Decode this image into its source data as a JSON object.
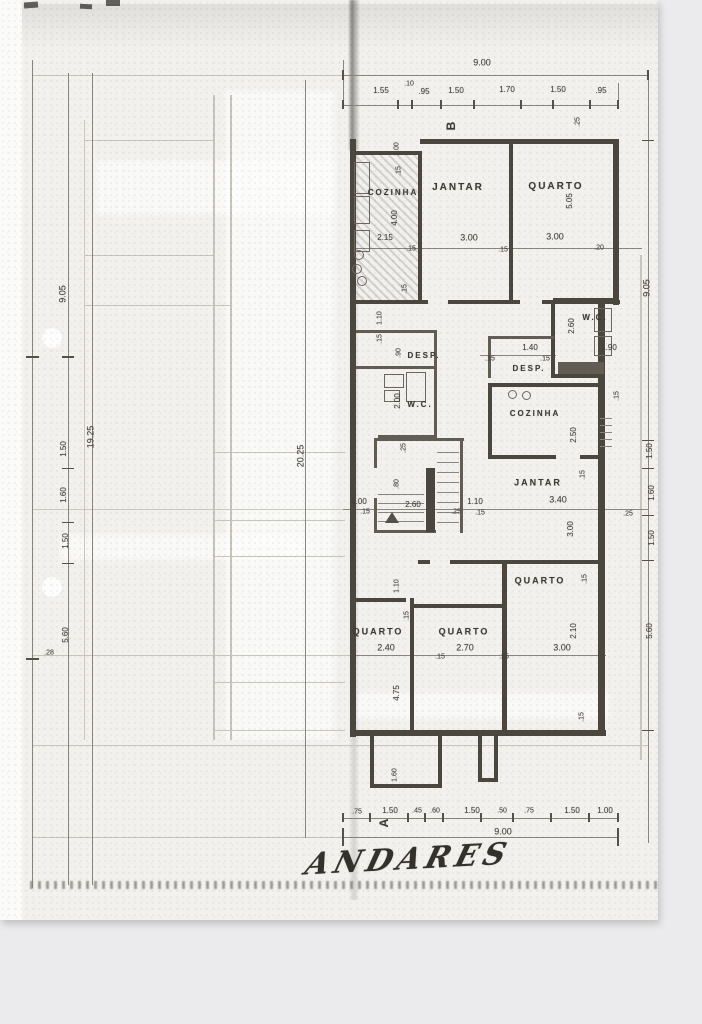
{
  "colors": {
    "ink": "#474339",
    "page": "#f2f1ee",
    "background": "#ebebed"
  },
  "plan": {
    "title": "ANDARES",
    "section_markers": {
      "top": "B",
      "bottom": "A"
    },
    "annotations": [
      {
        "n": "dim-label",
        "t": "9.00",
        "x": 482,
        "y": 63,
        "s": 9
      },
      {
        "n": "dim-label",
        "t": "1.55",
        "x": 381,
        "y": 91,
        "s": 8
      },
      {
        "n": "dim-label",
        "t": ".10",
        "x": 409,
        "y": 84,
        "s": 7
      },
      {
        "n": "dim-label",
        "t": ".95",
        "x": 424,
        "y": 92,
        "s": 8
      },
      {
        "n": "dim-label",
        "t": "1.50",
        "x": 456,
        "y": 91,
        "s": 8
      },
      {
        "n": "dim-label",
        "t": "1.70",
        "x": 507,
        "y": 90,
        "s": 8
      },
      {
        "n": "dim-label",
        "t": "1.50",
        "x": 558,
        "y": 90,
        "s": 8
      },
      {
        "n": "dim-label",
        "t": ".95",
        "x": 601,
        "y": 91,
        "s": 8
      },
      {
        "n": "section-marker-b",
        "t": "B",
        "x": 451,
        "y": 126,
        "r": -90,
        "s": 12,
        "c": "marker"
      },
      {
        "n": "dim-label",
        "t": ".25",
        "x": 578,
        "y": 122,
        "r": -90,
        "s": 7
      },
      {
        "n": "room-label-cozinha-top",
        "t": "COZINHA",
        "x": 393,
        "y": 193,
        "s": 8,
        "c": "room"
      },
      {
        "n": "room-label-jantar-top",
        "t": "JANTAR",
        "x": 458,
        "y": 188,
        "s": 10,
        "c": "room"
      },
      {
        "n": "room-label-quarto-top",
        "t": "QUARTO",
        "x": 556,
        "y": 187,
        "s": 10,
        "c": "room"
      },
      {
        "n": "dim-label",
        "t": "1.00",
        "x": 397,
        "y": 149,
        "r": -90,
        "s": 7
      },
      {
        "n": "dim-label",
        "t": ".15",
        "x": 399,
        "y": 171,
        "r": -90,
        "s": 7
      },
      {
        "n": "dim-label",
        "t": "4.00",
        "x": 395,
        "y": 218,
        "r": -90,
        "s": 8
      },
      {
        "n": "dim-label",
        "t": "5.05",
        "x": 570,
        "y": 201,
        "r": -90,
        "s": 8
      },
      {
        "n": "dim-label",
        "t": "2.15",
        "x": 385,
        "y": 238,
        "s": 8
      },
      {
        "n": "dim-label",
        "t": "3.00",
        "x": 469,
        "y": 238,
        "s": 9
      },
      {
        "n": "dim-label",
        "t": "3.00",
        "x": 555,
        "y": 237,
        "s": 9
      },
      {
        "n": "dim-label",
        "t": ".15",
        "x": 411,
        "y": 249,
        "s": 7
      },
      {
        "n": "dim-label",
        "t": ".15",
        "x": 503,
        "y": 250,
        "s": 7
      },
      {
        "n": "dim-label",
        "t": ".20",
        "x": 599,
        "y": 248,
        "s": 7
      },
      {
        "n": "dim-label",
        "t": ".15",
        "x": 405,
        "y": 289,
        "r": -90,
        "s": 7
      },
      {
        "n": "dim-label",
        "t": "1.10",
        "x": 380,
        "y": 318,
        "r": -90,
        "s": 7
      },
      {
        "n": "dim-label",
        "t": ".15",
        "x": 380,
        "y": 339,
        "r": -90,
        "s": 7
      },
      {
        "n": "dim-label",
        "t": ".90",
        "x": 399,
        "y": 353,
        "r": -90,
        "s": 7
      },
      {
        "n": "room-label-desp-left",
        "t": "DESP.",
        "x": 424,
        "y": 356,
        "s": 8,
        "c": "room"
      },
      {
        "n": "room-label-wc-left",
        "t": "W.C.",
        "x": 420,
        "y": 405,
        "s": 8,
        "c": "room"
      },
      {
        "n": "dim-label",
        "t": "2.00",
        "x": 398,
        "y": 401,
        "r": -90,
        "s": 8
      },
      {
        "n": "room-label-wc-right",
        "t": "W.C.",
        "x": 595,
        "y": 318,
        "s": 8,
        "c": "room"
      },
      {
        "n": "dim-label",
        "t": "2.60",
        "x": 572,
        "y": 326,
        "r": -90,
        "s": 8
      },
      {
        "n": "dim-label",
        "t": "1.40",
        "x": 530,
        "y": 348,
        "s": 8
      },
      {
        "n": "dim-label",
        "t": ".15",
        "x": 490,
        "y": 359,
        "s": 7
      },
      {
        "n": "dim-label",
        "t": ".15",
        "x": 545,
        "y": 359,
        "s": 7
      },
      {
        "n": "dim-label",
        "t": "1.90",
        "x": 609,
        "y": 348,
        "s": 8
      },
      {
        "n": "room-label-desp-right",
        "t": "DESP.",
        "x": 529,
        "y": 369,
        "s": 8,
        "c": "room"
      },
      {
        "n": "room-label-cozinha-right",
        "t": "COZINHA",
        "x": 535,
        "y": 414,
        "s": 8,
        "c": "room"
      },
      {
        "n": "dim-label",
        "t": "2.50",
        "x": 574,
        "y": 435,
        "r": -90,
        "s": 8
      },
      {
        "n": "dim-label",
        "t": ".15",
        "x": 617,
        "y": 396,
        "r": -90,
        "s": 7
      },
      {
        "n": "dim-label",
        "t": ".25",
        "x": 404,
        "y": 448,
        "r": -90,
        "s": 7
      },
      {
        "n": "dim-label",
        "t": ".80",
        "x": 397,
        "y": 484,
        "r": -90,
        "s": 7
      },
      {
        "n": "dim-label",
        "t": "2.60",
        "x": 413,
        "y": 505,
        "s": 8
      },
      {
        "n": "dim-label",
        "t": "1.00",
        "x": 359,
        "y": 502,
        "s": 8
      },
      {
        "n": "dim-label",
        "t": ".15",
        "x": 365,
        "y": 512,
        "s": 7
      },
      {
        "n": "dim-label",
        "t": ".25",
        "x": 456,
        "y": 512,
        "s": 7
      },
      {
        "n": "dim-label",
        "t": "1.10",
        "x": 475,
        "y": 502,
        "s": 8
      },
      {
        "n": "dim-label",
        "t": ".15",
        "x": 480,
        "y": 513,
        "s": 7
      },
      {
        "n": "room-label-jantar-mid",
        "t": "JANTAR",
        "x": 538,
        "y": 483,
        "s": 9,
        "c": "room"
      },
      {
        "n": "dim-label",
        "t": "3.40",
        "x": 558,
        "y": 500,
        "s": 9
      },
      {
        "n": "dim-label",
        "t": ".15",
        "x": 583,
        "y": 475,
        "r": -90,
        "s": 7
      },
      {
        "n": "dim-label",
        "t": "3.00",
        "x": 571,
        "y": 529,
        "r": -90,
        "s": 8
      },
      {
        "n": "dim-label",
        "t": ".25",
        "x": 628,
        "y": 514,
        "s": 7
      },
      {
        "n": "room-label-quarto-right",
        "t": "QUARTO",
        "x": 540,
        "y": 581,
        "s": 9,
        "c": "room"
      },
      {
        "n": "dim-label",
        "t": ".15",
        "x": 585,
        "y": 579,
        "r": -90,
        "s": 7
      },
      {
        "n": "dim-label",
        "t": "2.10",
        "x": 574,
        "y": 631,
        "r": -90,
        "s": 8
      },
      {
        "n": "dim-label",
        "t": "3.00",
        "x": 562,
        "y": 648,
        "s": 9
      },
      {
        "n": "dim-label",
        "t": "1.10",
        "x": 397,
        "y": 586,
        "r": -90,
        "s": 7
      },
      {
        "n": "room-label-quarto-bottom-left",
        "t": "QUARTO",
        "x": 378,
        "y": 632,
        "s": 9,
        "c": "room"
      },
      {
        "n": "dim-label",
        "t": "2.40",
        "x": 386,
        "y": 648,
        "s": 9
      },
      {
        "n": "dim-label",
        "t": ".15",
        "x": 407,
        "y": 616,
        "r": -90,
        "s": 7
      },
      {
        "n": "room-label-quarto-bottom-mid",
        "t": "QUARTO",
        "x": 464,
        "y": 632,
        "s": 9,
        "c": "room"
      },
      {
        "n": "dim-label",
        "t": "2.70",
        "x": 465,
        "y": 648,
        "s": 9
      },
      {
        "n": "dim-label",
        "t": ".15",
        "x": 440,
        "y": 657,
        "s": 7
      },
      {
        "n": "dim-label",
        "t": ".25",
        "x": 504,
        "y": 657,
        "s": 7
      },
      {
        "n": "dim-label",
        "t": "4.75",
        "x": 397,
        "y": 693,
        "r": -90,
        "s": 8
      },
      {
        "n": "dim-label",
        "t": ".15",
        "x": 582,
        "y": 717,
        "r": -90,
        "s": 7
      },
      {
        "n": "dim-label",
        "t": "1.60",
        "x": 395,
        "y": 775,
        "r": -90,
        "s": 7
      },
      {
        "n": "dim-label",
        "t": ".75",
        "x": 357,
        "y": 812,
        "s": 7
      },
      {
        "n": "dim-label",
        "t": "1.50",
        "x": 390,
        "y": 811,
        "s": 8
      },
      {
        "n": "dim-label",
        "t": ".45",
        "x": 417,
        "y": 811,
        "s": 7
      },
      {
        "n": "dim-label",
        "t": ".60",
        "x": 435,
        "y": 811,
        "s": 7
      },
      {
        "n": "dim-label",
        "t": "1.50",
        "x": 472,
        "y": 811,
        "s": 8
      },
      {
        "n": "dim-label",
        "t": ".50",
        "x": 502,
        "y": 811,
        "s": 7
      },
      {
        "n": "dim-label",
        "t": ".75",
        "x": 529,
        "y": 811,
        "s": 7
      },
      {
        "n": "dim-label",
        "t": "1.50",
        "x": 572,
        "y": 811,
        "s": 8
      },
      {
        "n": "dim-label",
        "t": "1.00",
        "x": 605,
        "y": 811,
        "s": 8
      },
      {
        "n": "dim-label",
        "t": "9.00",
        "x": 503,
        "y": 832,
        "s": 9
      },
      {
        "n": "section-marker-a",
        "t": "A",
        "x": 384,
        "y": 823,
        "r": -90,
        "s": 12,
        "c": "marker"
      },
      {
        "n": "dim-label",
        "t": "9.05",
        "x": 63,
        "y": 294,
        "r": -90,
        "s": 9
      },
      {
        "n": "dim-label",
        "t": "19.25",
        "x": 91,
        "y": 437,
        "r": -90,
        "s": 9
      },
      {
        "n": "dim-label",
        "t": "1.50",
        "x": 64,
        "y": 449,
        "r": -90,
        "s": 8
      },
      {
        "n": "dim-label",
        "t": "1.60",
        "x": 64,
        "y": 495,
        "r": -90,
        "s": 8
      },
      {
        "n": "dim-label",
        "t": "1.50",
        "x": 66,
        "y": 541,
        "r": -90,
        "s": 8
      },
      {
        "n": "dim-label",
        "t": "5.60",
        "x": 66,
        "y": 635,
        "r": -90,
        "s": 8
      },
      {
        "n": "dim-label",
        "t": ".28",
        "x": 49,
        "y": 653,
        "s": 7
      },
      {
        "n": "dim-label",
        "t": "20.25",
        "x": 301,
        "y": 456,
        "r": -90,
        "s": 9
      },
      {
        "n": "dim-label",
        "t": "9.05",
        "x": 647,
        "y": 288,
        "r": -90,
        "s": 9
      },
      {
        "n": "dim-label",
        "t": "1.50",
        "x": 650,
        "y": 451,
        "r": -90,
        "s": 8
      },
      {
        "n": "dim-label",
        "t": "1.60",
        "x": 652,
        "y": 493,
        "r": -90,
        "s": 8
      },
      {
        "n": "dim-label",
        "t": "1.50",
        "x": 652,
        "y": 538,
        "r": -90,
        "s": 8
      },
      {
        "n": "dim-label",
        "t": "5.60",
        "x": 650,
        "y": 631,
        "r": -90,
        "s": 8
      },
      {
        "n": "plan-title",
        "t": "ANDARES",
        "x": 408,
        "y": 860,
        "s": 30,
        "r": -3,
        "k": -18,
        "c": "title"
      }
    ]
  }
}
